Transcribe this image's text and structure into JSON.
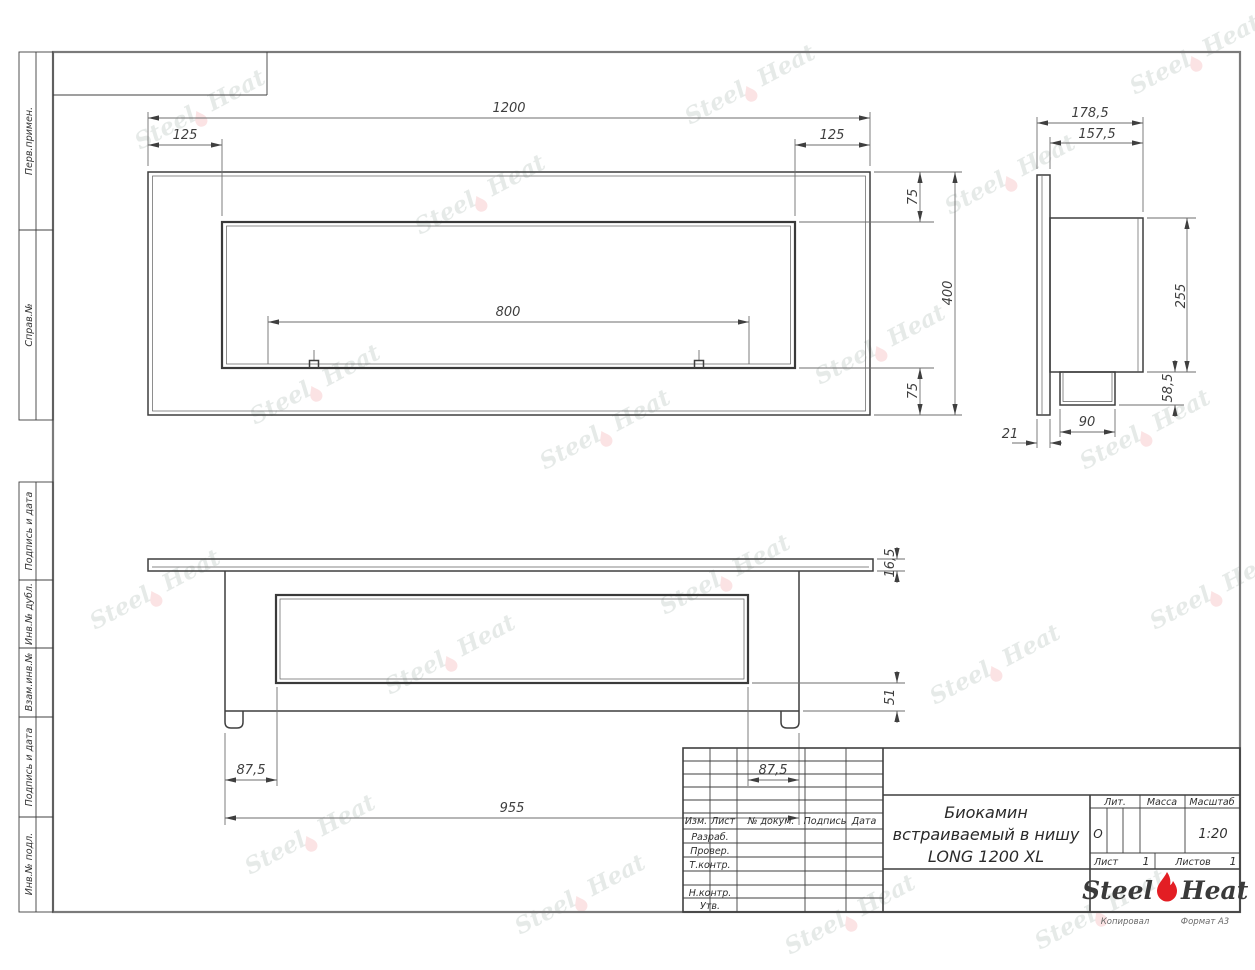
{
  "page": {
    "footer": {
      "copied": "Копировал",
      "format": "Формат А3"
    }
  },
  "watermark": {
    "left": "Steel",
    "right": "Heat"
  },
  "margin": {
    "items": [
      "Перв.примен.",
      "Справ.№",
      "Подпись и дата",
      "Инв.№ дубл.",
      "Взам.инв.№",
      "Подпись и дата",
      "Инв.№ подл."
    ]
  },
  "front_view": {
    "dims": {
      "width_total": "1200",
      "inset_left": "125",
      "inset_right": "125",
      "burner_width": "800",
      "margin_top": "75",
      "height_total": "400",
      "margin_bottom": "75"
    }
  },
  "side_view": {
    "dims": {
      "depth_total": "178,5",
      "depth_body": "157,5",
      "height_body": "255",
      "box_height": "58,5",
      "box_width": "90",
      "flange_thickness": "21"
    }
  },
  "bottom_view": {
    "dims": {
      "plate_thickness": "16,5",
      "lip_height": "51",
      "inset_left": "87,5",
      "inset_right": "87,5",
      "body_width": "955"
    }
  },
  "title_block": {
    "header_cols": [
      "Изм.",
      "Лист",
      "№ докум.",
      "Подпись",
      "Дата"
    ],
    "sign_rows": [
      "Разраб.",
      "Провер.",
      "Т.контр.",
      "Н.контр.",
      "Утв."
    ],
    "title_lines": [
      "Биокамин",
      "встраиваемый в нишу",
      "LONG 1200 XL"
    ],
    "lit_label": "Лит.",
    "lit_value": "О",
    "mass_label": "Масса",
    "scale_label": "Масштаб",
    "scale_value": "1:20",
    "sheet_label": "Лист",
    "sheet_value": "1",
    "sheets_label": "Листов",
    "sheets_value": "1",
    "logo": {
      "left": "Steel",
      "right": "Heat",
      "flame_color": "#e31e24"
    }
  }
}
